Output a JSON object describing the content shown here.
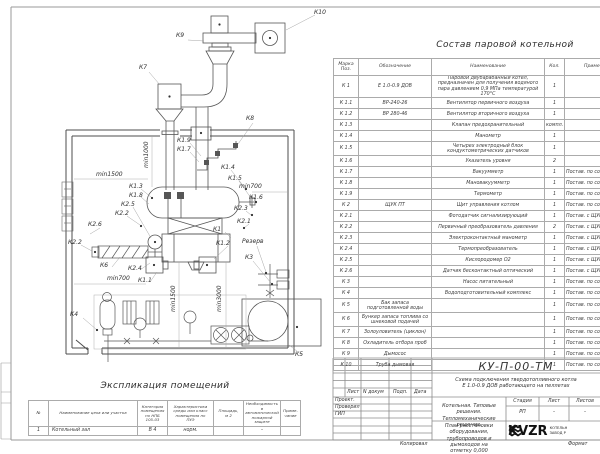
{
  "equipment_table": {
    "title": "Состав паровой котельной",
    "headers": [
      "Марка\nПоз.",
      "Обозначение",
      "Наименование",
      "Кол.",
      "Примечание"
    ],
    "col_widths": [
      25,
      73,
      113,
      20,
      69
    ],
    "rows": [
      {
        "mark": "К 1",
        "code": "Е 1.0-0.9 ДОВ",
        "name": "Паровой двубарабанный котел, предназначен для получения водяного пара давлением 0,9 МПа температурой 170°С",
        "qty": "1",
        "note": "",
        "h": 20
      },
      {
        "mark": "К 1.1",
        "code": "ВР-240-26",
        "name": "Вентилятор первичного воздуха",
        "qty": "1",
        "note": "",
        "h": 10
      },
      {
        "mark": "К 1.2",
        "code": "ВР 280-46",
        "name": "Вентилятор вторичного воздуха",
        "qty": "1",
        "note": "",
        "h": 10
      },
      {
        "mark": "К 1.3",
        "code": "",
        "name": "Клапан предохранительный",
        "qty": "компл.",
        "note": "",
        "h": 10
      },
      {
        "mark": "К 1.4",
        "code": "",
        "name": "Манометр",
        "qty": "1",
        "note": "",
        "h": 10
      },
      {
        "mark": "К 1.5",
        "code": "",
        "name": "Четырех электродный блок кондуктометрических датчиков",
        "qty": "1",
        "note": "",
        "h": 13
      },
      {
        "mark": "К 1.6",
        "code": "",
        "name": "Указатель уровня",
        "qty": "2",
        "note": "",
        "h": 10
      },
      {
        "mark": "К 1.7",
        "code": "",
        "name": "Вакуумметр",
        "qty": "1",
        "note": "Постав. по согла",
        "h": 10
      },
      {
        "mark": "К 1.8",
        "code": "",
        "name": "Мановакуумметр",
        "qty": "1",
        "note": "Постав. по согла",
        "h": 10
      },
      {
        "mark": "К 1.9",
        "code": "",
        "name": "Термометр",
        "qty": "1",
        "note": "Постав. по согла",
        "h": 10
      },
      {
        "mark": "К 2",
        "code": "ЩУК ПТ",
        "name": "Щит управления котлом",
        "qty": "1",
        "note": "Постав. по согла",
        "h": 10
      },
      {
        "mark": "К 2.1",
        "code": "",
        "name": "Фотодатчик сигнализирующий",
        "qty": "1",
        "note": "Постав. с ЩУК",
        "h": 10
      },
      {
        "mark": "К 2.2",
        "code": "",
        "name": "Первичный преобразователь давления",
        "qty": "2",
        "note": "Постав. с ЩУК",
        "h": 10
      },
      {
        "mark": "К 2.3",
        "code": "",
        "name": "Электроконтактный манометр",
        "qty": "1",
        "note": "Постав. с ЩУК",
        "h": 10
      },
      {
        "mark": "К 2.4",
        "code": "",
        "name": "Термопреобразователь",
        "qty": "1",
        "note": "Постав. с ЩУК",
        "h": 10
      },
      {
        "mark": "К 2.5",
        "code": "",
        "name": "Кислородомер О2",
        "qty": "1",
        "note": "Постав. с ЩУК",
        "h": 10
      },
      {
        "mark": "К 2.6",
        "code": "",
        "name": "Датчик бесконтактный оптический",
        "qty": "1",
        "note": "Постав. с ЩУК",
        "h": 10
      },
      {
        "mark": "К 3",
        "code": "",
        "name": "Насос питательный",
        "qty": "1",
        "note": "Постав. по согла",
        "h": 10
      },
      {
        "mark": "К 4",
        "code": "",
        "name": "Водоподготовительный комплекс",
        "qty": "1",
        "note": "Постав. по согла",
        "h": 10
      },
      {
        "mark": "К 5",
        "code": "Бак запаса подготовленной воды",
        "name": "",
        "qty": "1",
        "note": "Постав. по согла",
        "h": 13
      },
      {
        "mark": "К 6",
        "code": "Бункер запаса топлива со шнековой подачей",
        "name": "",
        "qty": "1",
        "note": "Постав. по согла",
        "h": 13
      },
      {
        "mark": "К 7",
        "code": "Золоуловитель (циклон)",
        "name": "",
        "qty": "1",
        "note": "Постав. по согла",
        "h": 10
      },
      {
        "mark": "К 8",
        "code": "Охладитель отбора проб",
        "name": "",
        "qty": "1",
        "note": "Постав. по согла",
        "h": 10
      },
      {
        "mark": "К 9",
        "code": "Дымосос",
        "name": "",
        "qty": "1",
        "note": "Постав. по согла",
        "h": 10
      },
      {
        "mark": "К 10",
        "code": "Труба дымовая",
        "name": "",
        "qty": "1",
        "note": "Постав. по согла",
        "h": 10
      }
    ]
  },
  "rooms_table": {
    "title": "Экспликация помещений",
    "headers": [
      "№",
      "Наименование цеха или участка",
      "Категория\nпомещения\nпо НПБ\n105-03",
      "Характеристика\nсреды или класс\nпомещения по\nПУЭ",
      "Площадь,\nм 2",
      "Необходимость в\nавтоматической\nпожарной защите",
      "Приме-\nчание"
    ],
    "col_widths": [
      20,
      89,
      30,
      46,
      30,
      37,
      20
    ],
    "rows": [
      [
        "1",
        "Котельный зал",
        "В 4",
        "норм.",
        "",
        "-",
        ""
      ]
    ]
  },
  "title_block": {
    "doc_number": "КУ-П-00-ТМ",
    "subtitle": "Схема подключения твердотопливного котла\nЕ 1.0-0.9 ДОВ работающего на пеллетах",
    "project": "Котельная. Типовые решения.\nТепломеханические решения.",
    "sheet_title": "План расстановки оборудования,\nтрубопроводов и дымоходов на\nотметку 0,000",
    "stage_headers": [
      "Стадия",
      "Лист",
      "Листов"
    ],
    "stage_values": [
      "РП",
      "-",
      "-"
    ],
    "sign_headers": [
      "Лист",
      "N докум",
      "Подп.",
      "Дата"
    ],
    "sign_rows": [
      "Проект.",
      "Проверил",
      "ГИП"
    ],
    "logo_text": "KVZR",
    "logo_caption": "КОТЕЛЬН\nЗАВОД Р",
    "footer_left": "Копировал",
    "footer_right": "Формат"
  },
  "drawing": {
    "labels": [
      {
        "t": "К10",
        "x": 314,
        "y": 10
      },
      {
        "t": "К9",
        "x": 176,
        "y": 33
      },
      {
        "t": "К7",
        "x": 139,
        "y": 65
      },
      {
        "t": "К8",
        "x": 246,
        "y": 116
      },
      {
        "t": "К1.9",
        "x": 177,
        "y": 138
      },
      {
        "t": "К1.7",
        "x": 177,
        "y": 147
      },
      {
        "t": "min1500",
        "x": 96,
        "y": 172
      },
      {
        "t": "min1000",
        "x": 144,
        "y": 168,
        "v": true
      },
      {
        "t": "К1.4",
        "x": 221,
        "y": 165
      },
      {
        "t": "К1.5",
        "x": 228,
        "y": 176
      },
      {
        "t": "min700",
        "x": 239,
        "y": 184
      },
      {
        "t": "К1.3",
        "x": 129,
        "y": 184
      },
      {
        "t": "К1.8",
        "x": 129,
        "y": 193
      },
      {
        "t": "К1.6",
        "x": 249,
        "y": 195
      },
      {
        "t": "К2.5",
        "x": 121,
        "y": 202
      },
      {
        "t": "К2.3",
        "x": 234,
        "y": 206
      },
      {
        "t": "К2.2",
        "x": 115,
        "y": 211
      },
      {
        "t": "К2.1",
        "x": 237,
        "y": 219
      },
      {
        "t": "К2.6",
        "x": 88,
        "y": 222
      },
      {
        "t": "К1",
        "x": 213,
        "y": 227
      },
      {
        "t": "К2.2",
        "x": 68,
        "y": 240
      },
      {
        "t": "К1.2",
        "x": 216,
        "y": 241
      },
      {
        "t": "Резерв",
        "x": 242,
        "y": 239
      },
      {
        "t": "К3",
        "x": 245,
        "y": 255
      },
      {
        "t": "К6",
        "x": 100,
        "y": 263
      },
      {
        "t": "К2.4",
        "x": 128,
        "y": 266
      },
      {
        "t": "min700",
        "x": 107,
        "y": 276
      },
      {
        "t": "К1.1",
        "x": 138,
        "y": 278
      },
      {
        "t": "min1500",
        "x": 171,
        "y": 312,
        "v": true
      },
      {
        "t": "min3000",
        "x": 217,
        "y": 312,
        "v": true
      },
      {
        "t": "К4",
        "x": 70,
        "y": 312
      },
      {
        "t": "К5",
        "x": 295,
        "y": 352
      }
    ]
  }
}
